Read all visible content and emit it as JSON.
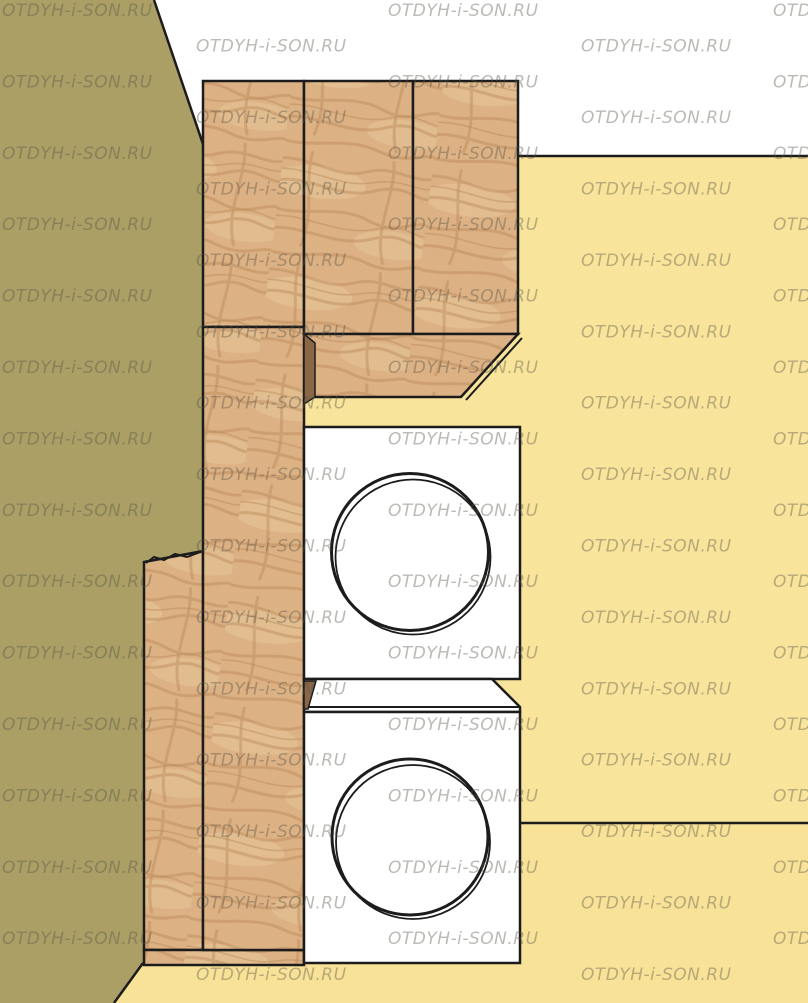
{
  "watermark": {
    "text": "OTDYH-i-SON.RU",
    "color": "#555246",
    "opacity": 0.4,
    "font_size": 17,
    "start_y": 16,
    "row_step": 35.7,
    "even_row_x": [
      2,
      388,
      773
    ],
    "odd_row_x": [
      196,
      581
    ],
    "max_y": 1008
  },
  "colors": {
    "upper_wall": "#ffffff",
    "left_wall": "#ab9f66",
    "back_wall": "#f9e49b",
    "floor": "#f8e298",
    "outline": "#1c1c1c",
    "wood_base": "#dcb184",
    "wood_grain": "#b98a58",
    "wood_grain_light": "#eed4a6",
    "wood_edge_dark": "#8a6847",
    "appliance_body": "#ffffff"
  },
  "objects": {
    "left_wall": "left-wall",
    "back_wall": "back-wall",
    "upper_wall": "upper-wall",
    "floor": "floor",
    "upper_cabinet": "upper-cabinet",
    "tall_cabinet": "tall-cabinet",
    "side_panel": "side-panel",
    "plinth": "plinth",
    "top_washer": "top-washing-machine",
    "bottom_washer": "bottom-washing-machine"
  }
}
